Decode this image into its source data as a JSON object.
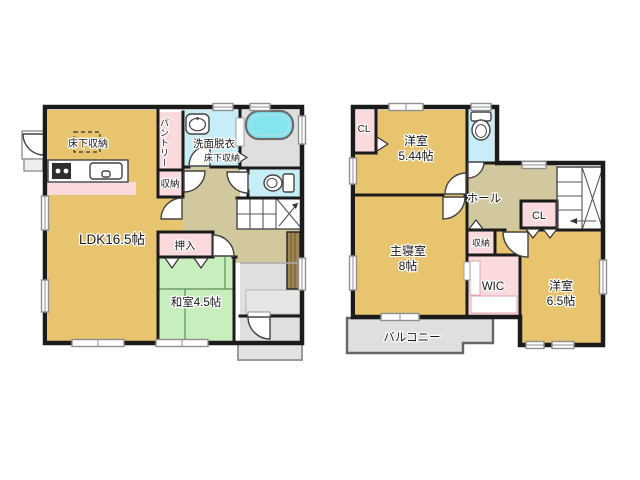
{
  "colors": {
    "wall": "#1b1b1b",
    "room_tan": "#e8c46e",
    "closet_pink": "#fadadd",
    "wet_cyan": "#c7eef7",
    "tub_cyan": "#84e4ef",
    "tatami_green": "#c9eebe",
    "hall_olive": "#d2c89e",
    "floor_gray": "#dfdfdf",
    "porch_gray": "#e3e3e3",
    "cabinet_brown": "#9e8653"
  },
  "floor1": {
    "labels": {
      "underfloor_storage": "床下収納",
      "pantry": "パントリー",
      "washroom": "洗面脱衣",
      "underfloor_storage2": "床下収納",
      "storage": "収納",
      "ldk": "LDK16.5帖",
      "oshiire": "押入",
      "washitsu": "和室4.5帖"
    }
  },
  "floor2": {
    "labels": {
      "cl_north": "CL",
      "yoshitsu1": "洋室",
      "yoshitsu1_size": "5.44帖",
      "hall": "ホール",
      "cl_center": "CL",
      "storage": "収納",
      "master": "主寝室",
      "master_size": "8帖",
      "wic": "WIC",
      "yoshitsu2": "洋室",
      "yoshitsu2_size": "6.5帖",
      "balcony": "バルコニー"
    }
  }
}
